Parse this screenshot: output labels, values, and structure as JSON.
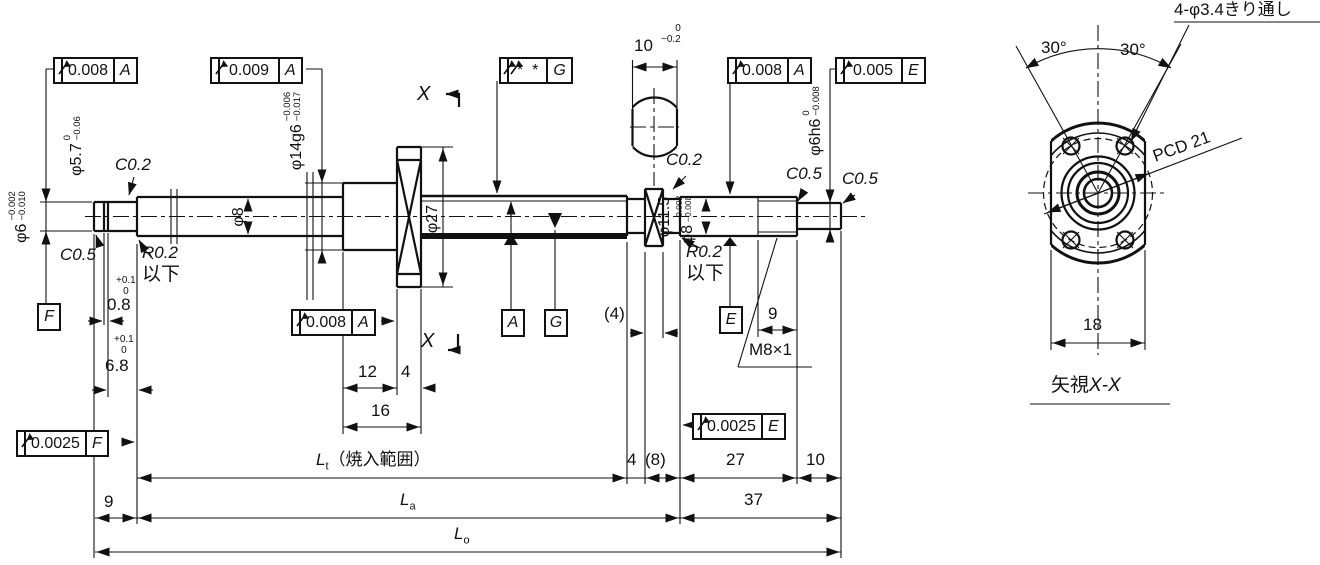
{
  "frames": {
    "runout_phi6": {
      "symbol": "circular-runout",
      "tolerance": "0.008",
      "datum": "A"
    },
    "runout_phi14": {
      "symbol": "circular-runout",
      "tolerance": "0.009",
      "datum": "A"
    },
    "runout_groove": {
      "symbol": "circular-runout-double",
      "tolerance": "*  *",
      "datum": "G"
    },
    "runout_phi8": {
      "symbol": "circular-runout",
      "tolerance": "0.008",
      "datum": "A"
    },
    "runout_phi6h6": {
      "symbol": "circular-runout",
      "tolerance": "0.005",
      "datum": "E"
    },
    "runout_flange": {
      "symbol": "circular-runout",
      "tolerance": "0.008",
      "datum": "A"
    },
    "runout_end_e": {
      "symbol": "circular-runout",
      "tolerance": "0.0025",
      "datum": "E"
    },
    "runout_end_f": {
      "symbol": "circular-runout",
      "tolerance": "0.0025",
      "datum": "F"
    }
  },
  "datums": {
    "a": "A",
    "g": "G",
    "e": "E",
    "f": "F"
  },
  "diameters": {
    "phi6": {
      "label": "φ6",
      "tol_upper": "−0.002",
      "tol_lower": "−0.010"
    },
    "phi5_7": {
      "label": "φ5.7",
      "tol_upper": "0",
      "tol_lower": "−0.06"
    },
    "phi14": {
      "label": "φ14g6",
      "tol_upper": "−0.006",
      "tol_lower": "−0.017"
    },
    "phi8_left": {
      "label": "φ8"
    },
    "phi27": {
      "label": "φ27"
    },
    "phi11_5": {
      "label": "φ11.5"
    },
    "phi8_right": {
      "label": "φ8",
      "tol_upper": "−0.002",
      "tol_lower": "−0.008"
    },
    "phi6h6": {
      "label": "φ6h6",
      "tol_upper": "0",
      "tol_lower": "−0.008"
    }
  },
  "notes": {
    "chamfer_02": "C0.2",
    "chamfer_05": "C0.5",
    "radius_02": "R0.2",
    "or_less": "以下",
    "thread": "M8×1"
  },
  "dims": {
    "groove_w": "0.8",
    "groove_loc": "6.8",
    "plus_tol": "+0.1",
    "zero": "0",
    "hub_len": "12",
    "flange_w": "4",
    "hub_total": "16",
    "flats_w": "10",
    "flats_tol_up": "0",
    "flats_tol_lo": "−0.2",
    "collar_w": "(4)",
    "thread_len": "9",
    "left_end": "9",
    "seg4": "4",
    "seg8": "(8)",
    "seg27": "27",
    "seg10": "10",
    "seg37": "37",
    "end_width": "18"
  },
  "lengths": {
    "sym": "L",
    "t": "t",
    "a": "a",
    "o": "o",
    "hardening": "（焼入範囲）"
  },
  "section": {
    "x": "X",
    "caption_prefix": "矢視",
    "caption_xx": "X-X"
  },
  "end_view": {
    "holes_note": "4-φ3.4きり通し",
    "angle_left": "30°",
    "angle_right": "30°",
    "pcd": "PCD 21"
  }
}
